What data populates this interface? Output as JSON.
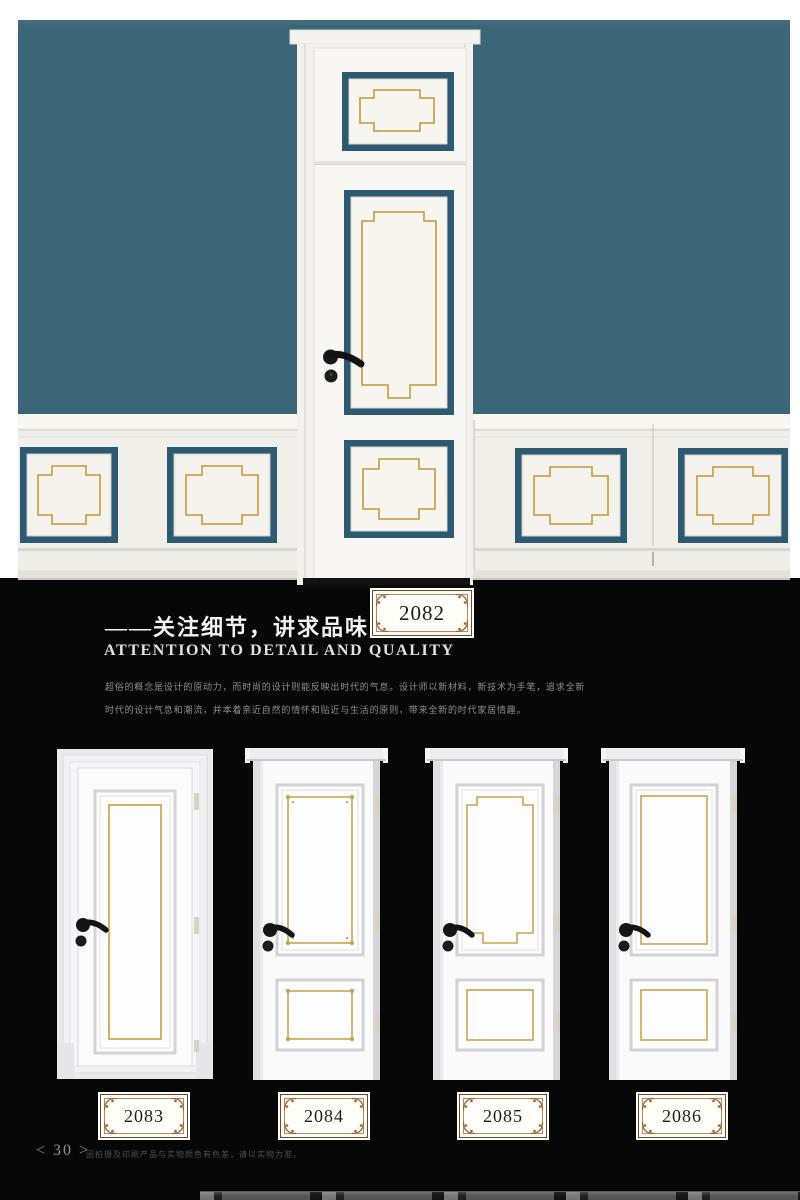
{
  "palette": {
    "wall_teal": "#3b6678",
    "panel_border_teal": "#2d5a70",
    "trim_gold": "#c8a44e",
    "wainscot_white": "#f1efe9",
    "door_white": "#f8f7f3",
    "section_black": "#070707",
    "badge_frame_brown": "#96653c",
    "handle_black": "#161616"
  },
  "section": {
    "badge": "2082",
    "title_cn": "——关注细节，讲求品味",
    "title_en": "ATTENTION TO DETAIL AND QUALITY",
    "body_line1": "超俗的概念是设计的原动力，而时尚的设计则能反映出时代的气息。设计师以新材料，新技术为手笔，追求全新",
    "body_line2": "时代的设计气息和潮流，并本着亲近自然的情怀和贴近与生活的原则，带来全新的时代家居情趣。"
  },
  "products": [
    {
      "id": "2083",
      "style": "single-tall-panel"
    },
    {
      "id": "2084",
      "style": "two-panel-corner-ornament"
    },
    {
      "id": "2085",
      "style": "two-panel-notched"
    },
    {
      "id": "2086",
      "style": "two-panel-plain"
    }
  ],
  "footer": {
    "page_indicator": "< 30 >",
    "note": "因拍摄及印刷产品与实物颜色有色差，请以实物为准。"
  }
}
